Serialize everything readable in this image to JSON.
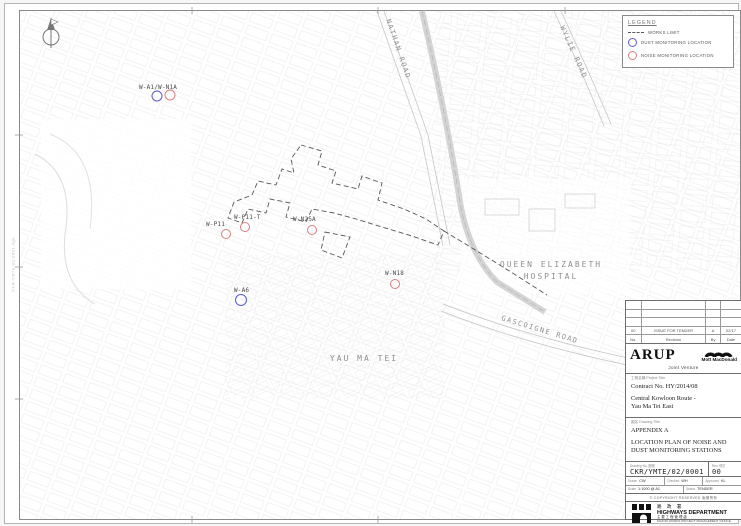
{
  "sheet": {
    "margin_note": "CKR-YMTE-02-0001.dgn",
    "north_label": "N"
  },
  "legend": {
    "title": "LEGEND",
    "works_limit_label": "WORKS LIMIT",
    "dust_label": "DUST MONITORING LOCATION",
    "noise_label": "NOISE MONITORING LOCATION",
    "dust_color": "#5b5bcf",
    "noise_color": "#d97f7f",
    "works_limit_color": "#555555"
  },
  "map": {
    "place_labels": [
      {
        "text": "NATHAN ROAD",
        "x": 381,
        "y": 16,
        "rot": 71,
        "size": 7,
        "ls": 1.5,
        "anchor": "start"
      },
      {
        "text": "WYLIE ROAD",
        "x": 555,
        "y": 23,
        "rot": 66,
        "size": 7,
        "ls": 1.5,
        "anchor": "start"
      },
      {
        "text": "GASCOIGNE ROAD",
        "x": 496,
        "y": 316,
        "rot": 17,
        "size": 7,
        "ls": 1.5,
        "anchor": "start"
      },
      {
        "text": "QUEEN ELIZABETH",
        "x": 546,
        "y": 263,
        "rot": 0,
        "size": 8,
        "ls": 2,
        "anchor": "middle"
      },
      {
        "text": "HOSPITAL",
        "x": 546,
        "y": 275,
        "rot": 0,
        "size": 8,
        "ls": 2,
        "anchor": "middle"
      },
      {
        "text": "YAU MA TEI",
        "x": 359,
        "y": 357,
        "rot": 0,
        "size": 8,
        "ls": 2,
        "anchor": "middle"
      }
    ],
    "stations": [
      {
        "label": "W-A1/W-N1A",
        "lx": 134,
        "ly": 85,
        "markers": [
          {
            "t": "dust",
            "x": 152,
            "y": 92,
            "r": 5
          },
          {
            "t": "noise",
            "x": 165,
            "y": 91,
            "r": 5
          }
        ]
      },
      {
        "label": "W-P11",
        "lx": 201,
        "ly": 222,
        "markers": [
          {
            "t": "noise",
            "x": 221,
            "y": 230,
            "r": 4.5
          }
        ]
      },
      {
        "label": "W-P11-T",
        "lx": 229,
        "ly": 215,
        "markers": [
          {
            "t": "noise",
            "x": 240,
            "y": 223,
            "r": 4.5
          }
        ]
      },
      {
        "label": "W-N25A",
        "lx": 288,
        "ly": 217,
        "markers": [
          {
            "t": "noise",
            "x": 307,
            "y": 226,
            "r": 4.5
          }
        ]
      },
      {
        "label": "W-A6",
        "lx": 229,
        "ly": 288,
        "markers": [
          {
            "t": "dust",
            "x": 236,
            "y": 296,
            "r": 5.5
          }
        ]
      },
      {
        "label": "W-N18",
        "lx": 380,
        "ly": 271,
        "markers": [
          {
            "t": "noise",
            "x": 390,
            "y": 280,
            "r": 4.5
          }
        ]
      }
    ]
  },
  "titleblock": {
    "revision_entry": {
      "no": "00",
      "description": "ISSUE FOR TENDER",
      "by": "A",
      "date": "02/17"
    },
    "revision_header": {
      "no": "No.",
      "description": "Revision",
      "by": "By",
      "date": "Date"
    },
    "arup": "ARUP",
    "mott": "Mott MacDonald",
    "joint_venture": "Joint Venture",
    "project_label": "工程名稱 Project Title",
    "contract_no": "Contract No. HY/2014/08",
    "project_title_1": "Central Kowloon Route -",
    "project_title_2": "Yau Ma Tei East",
    "drawing_label": "圖名 Drawing Title",
    "appendix": "APPENDIX A",
    "drawing_title_1": "LOCATION PLAN OF NOISE AND",
    "drawing_title_2": "DUST MONITORING STATIONS",
    "drawing_no_label": "Drawing No. 圖號",
    "drawing_no": "CKR/YMTE/02/0001",
    "rev_label": "Rev. 修訂",
    "rev": "00",
    "fields_row1": [
      {
        "label": "Drawn",
        "value": "CW"
      },
      {
        "label": "Checked",
        "value": "WH"
      },
      {
        "label": "Approved",
        "value": "KL"
      }
    ],
    "fields_row2": [
      {
        "label": "Scale",
        "value": "1:1000 @ A1"
      },
      {
        "label": "Status",
        "value": "TENDER"
      }
    ],
    "copyright": "© COPYRIGHT RESERVED 版權所有",
    "hyd_cn": "路 政 署",
    "hyd_en": "HIGHWAYS DEPARTMENT",
    "mwpmo_cn": "主要工程管理處",
    "mwpmo_en": "MAJOR WORKS PROJECT MANAGEMENT OFFICE"
  }
}
